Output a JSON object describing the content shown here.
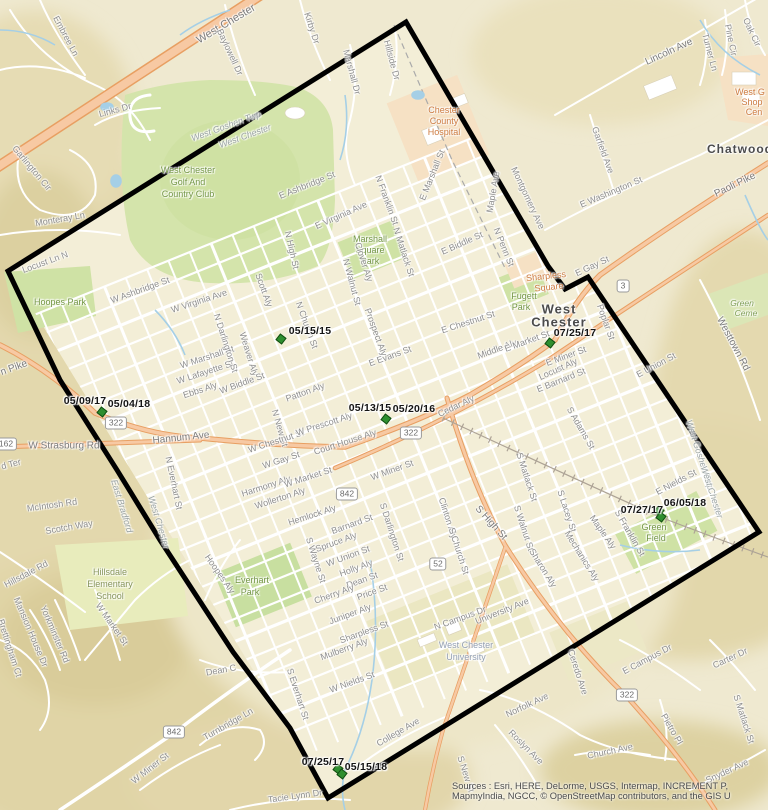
{
  "map_title": "West Chester borough boundary map with inspection date markers",
  "attribution": {
    "line1": "Sources : Esri, HERE, DeLorme, USGS, Intermap, INCREMENT P,",
    "line2": "MapmyIndia, NGCC, © OpenStreetMap contributors, and the GIS U"
  },
  "colors": {
    "base": "#efe9d0",
    "terrain": "#e3d8ad",
    "park_green": "#cfe2a5",
    "poi_orange_area": "#f6e1c4",
    "road_orange": "#f7c9a3",
    "road_casing": "#e89f62",
    "water": "#a5cfe6",
    "boundary": "#000000",
    "marker_green": "#2f8f2f"
  },
  "boundary": {
    "points": "406,22 548,266 565,289 588,277 759,532 328,798 290,728 233,652 160,540 117,470 60,380 8,271"
  },
  "markers": [
    {
      "pts": [
        [
          281,
          339
        ]
      ],
      "labels": [
        {
          "t": "05/15/15",
          "x": 310,
          "y": 331
        }
      ]
    },
    {
      "pts": [
        [
          102,
          412
        ]
      ],
      "labels": [
        {
          "t": "05/09/17",
          "x": 85,
          "y": 401
        },
        {
          "t": "05/04/18",
          "x": 129,
          "y": 404
        }
      ]
    },
    {
      "pts": [
        [
          386,
          419
        ]
      ],
      "labels": [
        {
          "t": "05/13/15",
          "x": 370,
          "y": 408
        },
        {
          "t": "05/20/16",
          "x": 414,
          "y": 409
        }
      ]
    },
    {
      "pts": [
        [
          550,
          343
        ]
      ],
      "labels": [
        {
          "t": "07/25/17",
          "x": 575,
          "y": 333
        }
      ]
    },
    {
      "pts": [
        [
          659,
          511
        ],
        [
          661,
          517
        ]
      ],
      "labels": [
        {
          "t": "07/27/17",
          "x": 642,
          "y": 510
        },
        {
          "t": "06/05/18",
          "x": 685,
          "y": 503
        }
      ]
    },
    {
      "pts": [
        [
          338,
          769
        ],
        [
          342,
          774
        ]
      ],
      "labels": [
        {
          "t": "07/25/17",
          "x": 323,
          "y": 762
        },
        {
          "t": "05/15/18",
          "x": 366,
          "y": 767
        }
      ]
    }
  ],
  "shields": [
    {
      "t": "322",
      "x": 116,
      "y": 423
    },
    {
      "t": "322",
      "x": 411,
      "y": 433
    },
    {
      "t": "322",
      "x": 627,
      "y": 695
    },
    {
      "t": "162",
      "x": 6,
      "y": 444
    },
    {
      "t": "842",
      "x": 347,
      "y": 494
    },
    {
      "t": "842",
      "x": 174,
      "y": 732
    },
    {
      "t": "52",
      "x": 438,
      "y": 564
    },
    {
      "t": "3",
      "x": 623,
      "y": 286
    }
  ],
  "labels": [
    {
      "t": "Embree Ln",
      "x": 66,
      "y": 36,
      "r": 62
    },
    {
      "t": "West Chester",
      "x": 226,
      "y": 24,
      "r": -31,
      "c": "stm",
      "s": 11
    },
    {
      "t": "Kirby Dr",
      "x": 312,
      "y": 28,
      "r": 72
    },
    {
      "t": "Baylowell Dr",
      "x": 230,
      "y": 52,
      "r": 65
    },
    {
      "t": "Marshall Dr",
      "x": 352,
      "y": 72,
      "r": 75
    },
    {
      "t": "Hillside Dr",
      "x": 392,
      "y": 60,
      "r": 75
    },
    {
      "t": "Links Dr",
      "x": 115,
      "y": 110,
      "r": -15
    },
    {
      "t": "Garlington Cir",
      "x": 32,
      "y": 168,
      "r": 50
    },
    {
      "t": "Monteray Ln",
      "x": 60,
      "y": 219,
      "r": -10
    },
    {
      "t": "West Goshen Twp",
      "x": 226,
      "y": 126,
      "r": -20,
      "c": "twp"
    },
    {
      "t": "West Chester",
      "x": 245,
      "y": 136,
      "r": -20,
      "c": "twp"
    },
    {
      "t": "West Chester",
      "x": 188,
      "y": 170,
      "c": "park"
    },
    {
      "t": "Golf And",
      "x": 188,
      "y": 182,
      "c": "park"
    },
    {
      "t": "Country Club",
      "x": 188,
      "y": 194,
      "c": "park"
    },
    {
      "t": "Locust Ln N",
      "x": 45,
      "y": 262,
      "r": -20
    },
    {
      "t": "E Ashbridge St",
      "x": 307,
      "y": 185,
      "r": -22
    },
    {
      "t": "N High St",
      "x": 292,
      "y": 250,
      "r": 77
    },
    {
      "t": "E Virginia Ave",
      "x": 341,
      "y": 215,
      "r": -24
    },
    {
      "t": "N Franklin St",
      "x": 387,
      "y": 200,
      "r": 70
    },
    {
      "t": "E Marshall St",
      "x": 432,
      "y": 175,
      "r": -68
    },
    {
      "t": "Chester",
      "x": 444,
      "y": 110,
      "c": "poi"
    },
    {
      "t": "County",
      "x": 444,
      "y": 121,
      "c": "poi"
    },
    {
      "t": "Hospital",
      "x": 444,
      "y": 132,
      "c": "poi"
    },
    {
      "t": "Maple Ave",
      "x": 493,
      "y": 192,
      "r": -80
    },
    {
      "t": "Montgomery Ave",
      "x": 528,
      "y": 198,
      "r": 65
    },
    {
      "t": "Lincoln Ave",
      "x": 669,
      "y": 52,
      "r": -25,
      "c": "stm"
    },
    {
      "t": "Turner Ln",
      "x": 710,
      "y": 52,
      "r": 75
    },
    {
      "t": "Oak Cir",
      "x": 752,
      "y": 32,
      "r": 65
    },
    {
      "t": "Pine Cir",
      "x": 731,
      "y": 40,
      "r": 78
    },
    {
      "t": "Garfield Ave",
      "x": 603,
      "y": 150,
      "r": 70
    },
    {
      "t": "E Washington St",
      "x": 611,
      "y": 192,
      "r": -23
    },
    {
      "t": "Paoli Pike",
      "x": 735,
      "y": 185,
      "r": -26,
      "c": "stm"
    },
    {
      "t": "West G",
      "x": 750,
      "y": 92,
      "c": "poi"
    },
    {
      "t": "Shop",
      "x": 752,
      "y": 102,
      "c": "poi"
    },
    {
      "t": "Cen",
      "x": 754,
      "y": 112,
      "c": "poi"
    },
    {
      "t": "Chatwood",
      "x": 740,
      "y": 149,
      "c": "city",
      "s": 12
    },
    {
      "t": "E Biddle St",
      "x": 462,
      "y": 243,
      "r": -24
    },
    {
      "t": "N Penn St",
      "x": 504,
      "y": 247,
      "r": 68
    },
    {
      "t": "Marshall",
      "x": 370,
      "y": 239,
      "c": "park"
    },
    {
      "t": "Square",
      "x": 370,
      "y": 250,
      "c": "park"
    },
    {
      "t": "Park",
      "x": 370,
      "y": 261,
      "c": "park"
    },
    {
      "t": "N Matlack St",
      "x": 404,
      "y": 252,
      "r": 72
    },
    {
      "t": "N Walnut St",
      "x": 352,
      "y": 282,
      "r": 75
    },
    {
      "t": "Clover Aly",
      "x": 364,
      "y": 262,
      "r": 72
    },
    {
      "t": "Prospect Aly",
      "x": 376,
      "y": 332,
      "r": 70
    },
    {
      "t": "Scott Aly",
      "x": 264,
      "y": 290,
      "r": 70
    },
    {
      "t": "N Church St",
      "x": 307,
      "y": 325,
      "r": 70
    },
    {
      "t": "W Virginia Ave",
      "x": 199,
      "y": 301,
      "r": -18
    },
    {
      "t": "W Ashbridge St",
      "x": 140,
      "y": 290,
      "r": -20
    },
    {
      "t": "Hoopes Park",
      "x": 60,
      "y": 302,
      "c": "park"
    },
    {
      "t": "W Marshall St",
      "x": 207,
      "y": 357,
      "r": -18
    },
    {
      "t": "W Lafayette St",
      "x": 205,
      "y": 372,
      "r": -18
    },
    {
      "t": "Ebbs Aly",
      "x": 200,
      "y": 390,
      "r": -18
    },
    {
      "t": "Weaver Aly",
      "x": 249,
      "y": 354,
      "r": 73
    },
    {
      "t": "N Darlington St",
      "x": 226,
      "y": 343,
      "r": 72
    },
    {
      "t": "N New St",
      "x": 280,
      "y": 428,
      "r": 74
    },
    {
      "t": "W Biddle St",
      "x": 242,
      "y": 383,
      "r": -20
    },
    {
      "t": "Patton Aly",
      "x": 305,
      "y": 392,
      "r": -20
    },
    {
      "t": "W Chestnut St",
      "x": 276,
      "y": 441,
      "r": -18
    },
    {
      "t": "E Chestnut St",
      "x": 468,
      "y": 322,
      "r": -18
    },
    {
      "t": "W Prescott Aly",
      "x": 324,
      "y": 424,
      "r": -18
    },
    {
      "t": "Court House Aly",
      "x": 345,
      "y": 442,
      "r": -18
    },
    {
      "t": "Hannum Ave",
      "x": 181,
      "y": 438,
      "r": -6,
      "c": "stm"
    },
    {
      "t": "W Strasburg Rd",
      "x": 64,
      "y": 446,
      "r": 0,
      "c": "stm"
    },
    {
      "t": "n Pike",
      "x": 14,
      "y": 368,
      "r": -20,
      "c": "stm"
    },
    {
      "t": "McIntosh Rd",
      "x": 52,
      "y": 505,
      "r": -8
    },
    {
      "t": "Scotch Way",
      "x": 69,
      "y": 527,
      "r": -10
    },
    {
      "t": "d Ter",
      "x": 11,
      "y": 464,
      "r": -15
    },
    {
      "t": "East Bradford",
      "x": 122,
      "y": 506,
      "r": 73,
      "c": "twp"
    },
    {
      "t": "West Chester",
      "x": 159,
      "y": 522,
      "r": 73,
      "c": "twp"
    },
    {
      "t": "N Everhart St",
      "x": 174,
      "y": 483,
      "r": 78
    },
    {
      "t": "W Gay St",
      "x": 281,
      "y": 460,
      "r": -18
    },
    {
      "t": "Harmony Aly",
      "x": 266,
      "y": 486,
      "r": -18
    },
    {
      "t": "W Market St",
      "x": 308,
      "y": 477,
      "r": -18
    },
    {
      "t": "Wollerton Aly",
      "x": 280,
      "y": 498,
      "r": -18
    },
    {
      "t": "Hemlock Aly",
      "x": 312,
      "y": 515,
      "r": -18
    },
    {
      "t": "Barnard St",
      "x": 352,
      "y": 524,
      "r": -20
    },
    {
      "t": "W Miner St",
      "x": 392,
      "y": 470,
      "r": -20
    },
    {
      "t": "S Darlington St",
      "x": 392,
      "y": 532,
      "r": 72
    },
    {
      "t": "Clinton Aly",
      "x": 448,
      "y": 518,
      "r": 72
    },
    {
      "t": "S Church St",
      "x": 459,
      "y": 551,
      "r": 72
    },
    {
      "t": "S High St",
      "x": 491,
      "y": 523,
      "r": 48,
      "c": "stm"
    },
    {
      "t": "S Matlack St",
      "x": 527,
      "y": 477,
      "r": 72
    },
    {
      "t": "S Walnut St",
      "x": 524,
      "y": 528,
      "r": 72
    },
    {
      "t": "S Lacey St",
      "x": 567,
      "y": 511,
      "r": 72
    },
    {
      "t": "Sharon Aly",
      "x": 543,
      "y": 568,
      "r": 58
    },
    {
      "t": "Mechanics Aly",
      "x": 582,
      "y": 556,
      "r": 58
    },
    {
      "t": "S Adams St",
      "x": 581,
      "y": 428,
      "r": 60
    },
    {
      "t": "Cedar Aly",
      "x": 456,
      "y": 406,
      "r": -25
    },
    {
      "t": "Middle Aly",
      "x": 497,
      "y": 349,
      "r": -20
    },
    {
      "t": "E Market St",
      "x": 527,
      "y": 341,
      "r": -20
    },
    {
      "t": "E Miner St",
      "x": 566,
      "y": 356,
      "r": -20
    },
    {
      "t": "Locust Aly",
      "x": 558,
      "y": 369,
      "r": -24
    },
    {
      "t": "E Barnard St",
      "x": 561,
      "y": 380,
      "r": -22
    },
    {
      "t": "E Evans St",
      "x": 390,
      "y": 356,
      "r": -20
    },
    {
      "t": "E Gay St",
      "x": 592,
      "y": 266,
      "r": -25
    },
    {
      "t": "Fugett",
      "x": 524,
      "y": 296,
      "c": "park"
    },
    {
      "t": "Park",
      "x": 521,
      "y": 307,
      "c": "park"
    },
    {
      "t": "Sharpless",
      "x": 546,
      "y": 276,
      "r": -6,
      "c": "poi"
    },
    {
      "t": "Square",
      "x": 549,
      "y": 287,
      "r": -6,
      "c": "poi"
    },
    {
      "t": "West",
      "x": 559,
      "y": 309,
      "c": "city",
      "s": 13
    },
    {
      "t": "Chester",
      "x": 559,
      "y": 322,
      "c": "city",
      "s": 13
    },
    {
      "t": "Poplar St",
      "x": 606,
      "y": 322,
      "r": 70
    },
    {
      "t": "E Union St",
      "x": 656,
      "y": 365,
      "r": -28
    },
    {
      "t": "Westtown Rd",
      "x": 733,
      "y": 344,
      "r": 62,
      "c": "stm"
    },
    {
      "t": "Green",
      "x": 742,
      "y": 303,
      "c": "parkit"
    },
    {
      "t": "Ceme",
      "x": 746,
      "y": 313,
      "c": "parkit"
    },
    {
      "t": "West Goshen Twp",
      "x": 700,
      "y": 455,
      "r": 72,
      "c": "twp"
    },
    {
      "t": "West Chester",
      "x": 712,
      "y": 492,
      "r": 72,
      "c": "twp"
    },
    {
      "t": "E Nields St",
      "x": 676,
      "y": 482,
      "r": -28
    },
    {
      "t": "Green",
      "x": 654,
      "y": 527,
      "c": "park"
    },
    {
      "t": "Field",
      "x": 656,
      "y": 538,
      "c": "park"
    },
    {
      "t": "S Franklin St",
      "x": 630,
      "y": 533,
      "r": 60
    },
    {
      "t": "Maple Aly",
      "x": 603,
      "y": 532,
      "r": 55
    },
    {
      "t": "S Wayne St",
      "x": 316,
      "y": 560,
      "r": 72
    },
    {
      "t": "Spruce Aly",
      "x": 336,
      "y": 542,
      "r": -20
    },
    {
      "t": "W Union St",
      "x": 348,
      "y": 556,
      "r": -20
    },
    {
      "t": "Holly Aly",
      "x": 356,
      "y": 568,
      "r": -20
    },
    {
      "t": "Dean St",
      "x": 362,
      "y": 580,
      "r": -20
    },
    {
      "t": "Price St",
      "x": 372,
      "y": 592,
      "r": -20
    },
    {
      "t": "Cherry Aly",
      "x": 334,
      "y": 594,
      "r": -20
    },
    {
      "t": "Juniper Aly",
      "x": 350,
      "y": 614,
      "r": -20
    },
    {
      "t": "Sharpless St",
      "x": 364,
      "y": 632,
      "r": -20
    },
    {
      "t": "Mulberry Aly",
      "x": 344,
      "y": 649,
      "r": -20
    },
    {
      "t": "W Nields St",
      "x": 352,
      "y": 682,
      "r": -20
    },
    {
      "t": "S Everhart St",
      "x": 298,
      "y": 694,
      "r": 72
    },
    {
      "t": "Hoopes Aly",
      "x": 220,
      "y": 574,
      "r": 55
    },
    {
      "t": "Everhart",
      "x": 252,
      "y": 580,
      "c": "park"
    },
    {
      "t": "Park",
      "x": 250,
      "y": 592,
      "c": "park"
    },
    {
      "t": "Hillsdale",
      "x": 110,
      "y": 572,
      "c": "school"
    },
    {
      "t": "Elementary",
      "x": 110,
      "y": 584,
      "c": "school"
    },
    {
      "t": "School",
      "x": 110,
      "y": 596,
      "c": "school"
    },
    {
      "t": "Hillsdale Rd",
      "x": 26,
      "y": 574,
      "r": -28
    },
    {
      "t": "Brettingham Ct",
      "x": 10,
      "y": 648,
      "r": 72
    },
    {
      "t": "Mansion House Dr",
      "x": 31,
      "y": 632,
      "r": 67
    },
    {
      "t": "Yorkminster Rd",
      "x": 55,
      "y": 634,
      "r": 67
    },
    {
      "t": "W Market St",
      "x": 112,
      "y": 624,
      "r": 55
    },
    {
      "t": "Dean C",
      "x": 221,
      "y": 670,
      "r": -10
    },
    {
      "t": "Turnbridge Ln",
      "x": 228,
      "y": 724,
      "r": -30
    },
    {
      "t": "W Miner St",
      "x": 150,
      "y": 768,
      "r": -38
    },
    {
      "t": "Tacie Lynn Dr",
      "x": 295,
      "y": 796,
      "r": -8
    },
    {
      "t": "College Ave",
      "x": 398,
      "y": 732,
      "r": -30
    },
    {
      "t": "N Campus Dr",
      "x": 460,
      "y": 618,
      "r": -20
    },
    {
      "t": "University Ave",
      "x": 502,
      "y": 611,
      "r": -22
    },
    {
      "t": "West Chester",
      "x": 466,
      "y": 645,
      "c": "univ"
    },
    {
      "t": "University",
      "x": 466,
      "y": 657,
      "c": "univ"
    },
    {
      "t": "E Campus Dr",
      "x": 647,
      "y": 659,
      "r": -28
    },
    {
      "t": "Carter Dr",
      "x": 730,
      "y": 658,
      "r": -25
    },
    {
      "t": "Ceredo Ave",
      "x": 578,
      "y": 672,
      "r": 72
    },
    {
      "t": "Norfolk Ave",
      "x": 527,
      "y": 705,
      "r": -25
    },
    {
      "t": "Roslyn Ave",
      "x": 526,
      "y": 747,
      "r": 45
    },
    {
      "t": "Church Ave",
      "x": 610,
      "y": 751,
      "r": -12
    },
    {
      "t": "Pietro Pl",
      "x": 672,
      "y": 729,
      "r": 60
    },
    {
      "t": "S Matlack St",
      "x": 744,
      "y": 719,
      "r": 72
    },
    {
      "t": "Snyder Ave",
      "x": 727,
      "y": 771,
      "r": -25
    },
    {
      "t": "S New St",
      "x": 466,
      "y": 774,
      "r": 72
    }
  ]
}
